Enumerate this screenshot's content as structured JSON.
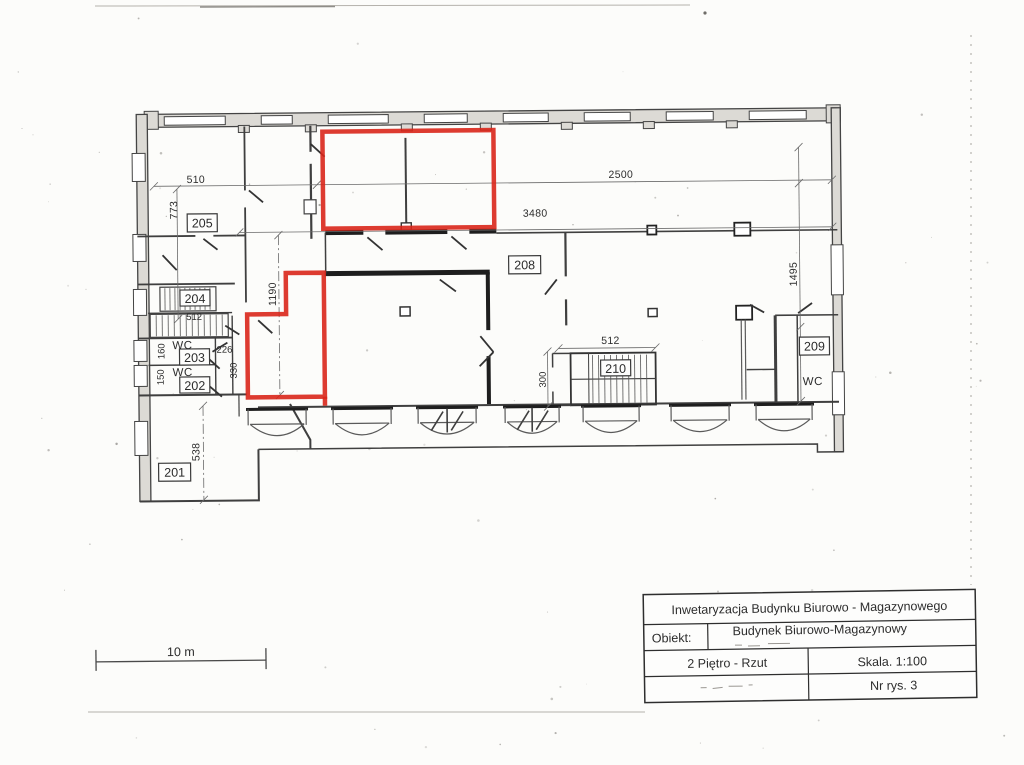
{
  "page": {
    "paper_color": "#fcfcfa",
    "ink_color": "#2c2c2c"
  },
  "plan": {
    "highlight_color": "#d9261a",
    "rooms": {
      "r201": "201",
      "r202": "202",
      "r203": "203",
      "r204": "204",
      "r205": "205",
      "r208": "208",
      "r209": "209",
      "r210": "210"
    },
    "wc": {
      "wc203": "WC",
      "wc202": "WC",
      "wc209": "WC"
    },
    "dims": {
      "d510": "510",
      "d773": "773",
      "d2500": "2500",
      "d3480": "3480",
      "d1190": "1190",
      "d1495": "1495",
      "d512s": "512",
      "d512m": "512",
      "d300": "300",
      "d330": "330",
      "d226": "226",
      "d160": "160",
      "d150": "150",
      "d538": "538"
    }
  },
  "scale_bar": {
    "label": "10 m"
  },
  "title_block": {
    "header": "Inwetaryzacja Budynku Biurowo - Magazynowego",
    "object_label": "Obiekt:",
    "object_value": "Budynek Biurowo-Magazynowy",
    "drawing_title": "2 Piętro - Rzut",
    "scale_label": "Skala. 1:100",
    "drawing_number": "Nr rys. 3"
  }
}
